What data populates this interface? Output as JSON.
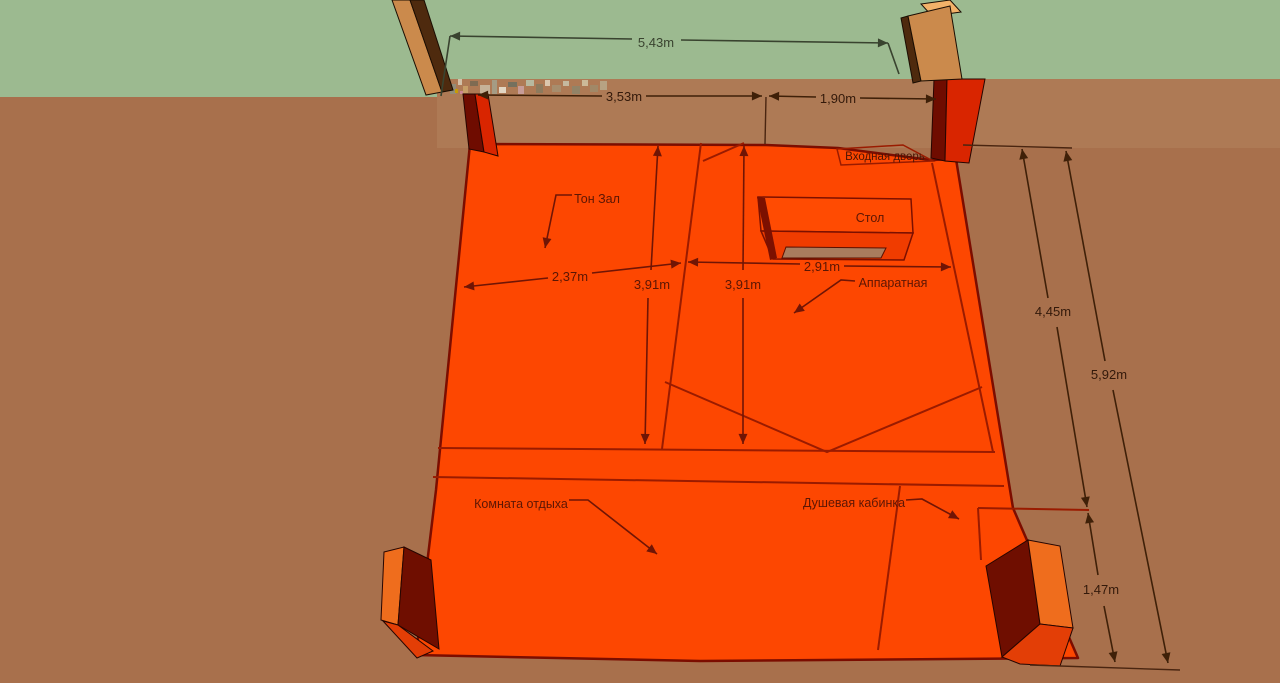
{
  "colors": {
    "wall_green": "#9cba90",
    "ground_brown": "#a8704c",
    "ground_brown_light": "#ae7a55",
    "floor_orange": "#fd4701",
    "floor_outline": "#7c0d00",
    "floor_line_red": "#9a1b00",
    "annotation_red": "#701505",
    "annotation_brown": "#3f2008",
    "annotation_green_area": "#39432f",
    "wood_light": "#cb8a4c",
    "wood_dark": "#4e2a0e",
    "wood_top": "#f2b269",
    "post_red": "#d92500",
    "post_red_dark": "#6f0c00",
    "block_orange": "#ef6d1d",
    "block_red": "#e33e06",
    "block_maroon": "#6f0e00",
    "table_top": "#ff4b02",
    "table_front": "#f03c00",
    "table_inset": "#a97c5e"
  },
  "labels": {
    "ton_zal": "Тон Зал",
    "stol": "Стол",
    "apparatnaya": "Аппаратная",
    "komnata_otdyha": "Комната отдыха",
    "dushevaya_kabinka": "Душевая кабинка",
    "vhodnaya_dver": "Входная дверь"
  },
  "dimensions": {
    "opening_width": "5,43m",
    "wall_segment": "3,53m",
    "door_width": "1,90m",
    "ton_zal_width": "2,37m",
    "ton_zal_depth": "3,91m",
    "hall_depth": "3,91m",
    "apparatnaya_width": "2,91m",
    "right_upper": "4,45m",
    "right_total": "5,92m",
    "right_lower": "1,47m"
  }
}
